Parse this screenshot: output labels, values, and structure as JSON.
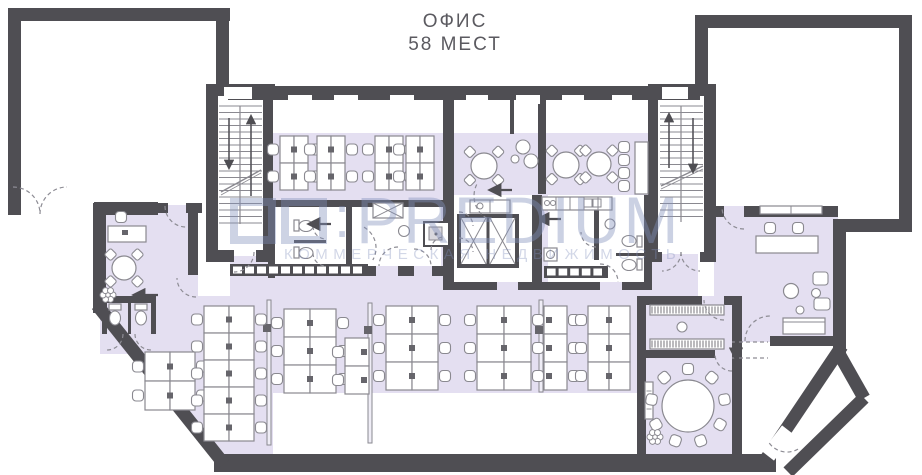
{
  "title": {
    "line1": "ОФИС",
    "line2": "58 МЕСТ"
  },
  "watermark": {
    "separator": ":",
    "brand": "PREDIUM",
    "tagline": "КОММЕРЧЕСКАЯ НЕДВИЖИМОСТЬ"
  },
  "colors": {
    "wall": "#4f4e53",
    "floor": "#e4dff1",
    "stroke": "#8a8990",
    "monitor": "#66656b",
    "dash": "#8d8c94",
    "white": "#ffffff",
    "partition": "#efedf6",
    "watermark": "rgba(131,145,188,0.42)",
    "title": "#5b5a60"
  },
  "plan": {
    "canvas": {
      "w": 922,
      "h": 475
    },
    "floor_zones": [
      {
        "t": "rect",
        "r": [
          228,
          133,
          470,
          169
        ]
      },
      {
        "t": "poly",
        "pts": [
          [
            97,
            296
          ],
          [
            230,
            296
          ],
          [
            230,
            302
          ],
          [
            637,
            302
          ],
          [
            637,
            458
          ],
          [
            225,
            458
          ],
          [
            97,
            308
          ]
        ]
      },
      {
        "t": "rect",
        "r": [
          637,
          296,
          103,
          162
        ]
      },
      {
        "t": "rect",
        "r": [
          95,
          205,
          103,
          100
        ]
      },
      {
        "t": "rect",
        "r": [
          100,
          296,
          58,
          58
        ]
      },
      {
        "t": "rect",
        "r": [
          714,
          206,
          124,
          136
        ]
      }
    ],
    "white_zones": [
      [
        275,
        207,
        166,
        59
      ],
      [
        454,
        195,
        78,
        87
      ],
      [
        548,
        195,
        96,
        87
      ],
      [
        273,
        393,
        364,
        63
      ],
      [
        218,
        96,
        45,
        160
      ],
      [
        658,
        96,
        46,
        158
      ],
      [
        198,
        213,
        32,
        83
      ]
    ],
    "walls": [
      [
        8,
        8,
        222,
        13
      ],
      [
        8,
        8,
        13,
        207
      ],
      [
        8,
        202,
        6,
        13
      ],
      [
        94,
        202,
        64,
        13
      ],
      [
        216,
        8,
        13,
        84
      ],
      [
        206,
        84,
        69,
        12
      ],
      [
        206,
        88,
        12,
        174
      ],
      [
        263,
        88,
        10,
        174
      ],
      [
        206,
        250,
        28,
        12
      ],
      [
        256,
        250,
        19,
        12
      ],
      [
        228,
        86,
        472,
        14
      ],
      [
        443,
        100,
        11,
        184
      ],
      [
        538,
        100,
        8,
        94
      ],
      [
        510,
        100,
        4,
        34
      ],
      [
        648,
        84,
        68,
        12
      ],
      [
        648,
        88,
        10,
        174
      ],
      [
        704,
        88,
        12,
        174
      ],
      [
        648,
        252,
        14,
        10
      ],
      [
        700,
        252,
        16,
        10
      ],
      [
        695,
        15,
        217,
        13
      ],
      [
        899,
        15,
        13,
        217
      ],
      [
        695,
        15,
        13,
        78
      ],
      [
        833,
        219,
        79,
        13
      ],
      [
        833,
        232,
        13,
        122
      ],
      [
        714,
        206,
        10,
        11
      ],
      [
        744,
        206,
        94,
        11
      ],
      [
        770,
        336,
        68,
        10
      ],
      [
        93,
        203,
        13,
        110
      ],
      [
        93,
        203,
        75,
        10
      ],
      [
        186,
        203,
        16,
        10
      ],
      [
        188,
        203,
        10,
        72
      ],
      [
        102,
        296,
        54,
        7
      ],
      [
        102,
        296,
        5,
        38
      ],
      [
        151,
        296,
        5,
        38
      ],
      [
        128,
        300,
        3,
        34
      ],
      [
        268,
        200,
        179,
        7
      ],
      [
        268,
        200,
        7,
        78
      ],
      [
        346,
        207,
        6,
        59
      ],
      [
        368,
        266,
        8,
        10
      ],
      [
        398,
        266,
        16,
        10
      ],
      [
        432,
        266,
        11,
        10
      ],
      [
        443,
        282,
        54,
        8
      ],
      [
        518,
        282,
        22,
        8
      ],
      [
        532,
        195,
        10,
        95
      ],
      [
        644,
        195,
        8,
        95
      ],
      [
        540,
        282,
        60,
        8
      ],
      [
        622,
        282,
        30,
        8
      ],
      [
        594,
        203,
        5,
        57
      ],
      [
        616,
        253,
        28,
        3
      ],
      [
        637,
        296,
        65,
        9
      ],
      [
        724,
        296,
        16,
        9
      ],
      [
        637,
        296,
        9,
        164
      ],
      [
        732,
        296,
        10,
        164
      ],
      [
        645,
        350,
        70,
        8
      ],
      [
        214,
        454,
        562,
        18
      ]
    ],
    "wall_lines": [
      [
        97,
        305,
        224,
        464,
        13
      ],
      [
        842,
        346,
        764,
        462,
        13
      ],
      [
        864,
        398,
        788,
        472,
        13
      ],
      [
        838,
        352,
        864,
        398,
        13
      ]
    ],
    "white_gaps": [
      [
        788,
        430,
        768,
        456,
        15
      ]
    ],
    "windows": [
      [
        224,
        87,
        28,
        12
      ],
      [
        662,
        87,
        26,
        12
      ],
      [
        288,
        95,
        24,
        9
      ],
      [
        334,
        95,
        24,
        9
      ],
      [
        390,
        95,
        24,
        9
      ],
      [
        466,
        95,
        22,
        9
      ],
      [
        516,
        95,
        24,
        9
      ],
      [
        562,
        95,
        22,
        9
      ],
      [
        612,
        95,
        20,
        9
      ]
    ],
    "lockers": [
      {
        "x": 230,
        "y": 264,
        "w": 138,
        "h": 12,
        "cells": 11
      },
      {
        "x": 544,
        "y": 266,
        "w": 64,
        "h": 12,
        "cells": 5
      }
    ],
    "stairs": [
      {
        "x": 219,
        "y": 106,
        "w": 43,
        "h": 118,
        "rail": 240,
        "slash": [
          221,
          192,
          261,
          170
        ],
        "arrows": [
          [
            229,
            118,
            229,
            168
          ],
          [
            251,
            196,
            251,
            116
          ]
        ]
      },
      {
        "x": 660,
        "y": 106,
        "w": 43,
        "h": 116,
        "rail": 681,
        "slash": [
          661,
          186,
          703,
          166
        ],
        "arrows": [
          [
            669,
            168,
            669,
            114
          ],
          [
            693,
            118,
            693,
            172
          ]
        ]
      }
    ],
    "elevator": {
      "box": [
        459,
        216,
        58,
        50
      ],
      "divX": 488
    },
    "elevator_counter": [
      470,
      200,
      40,
      13
    ],
    "kitchen_counter": {
      "r": [
        542,
        197,
        70,
        13
      ],
      "divs": [
        556,
        570,
        584,
        598
      ],
      "sink": [
        [
          584,
          199,
          8,
          8
        ],
        [
          593,
          199,
          8,
          8
        ]
      ],
      "burners": [
        [
          547,
          203
        ],
        [
          553,
          203
        ]
      ]
    },
    "bath_fixtures": {
      "toilets": [
        {
          "tank": [
            294,
            220,
            5,
            11
          ],
          "bowl": [
            306,
            226,
            7,
            5.5
          ]
        },
        {
          "tank": [
            294,
            247,
            5,
            11
          ],
          "bowl": [
            306,
            253,
            7,
            5.5
          ]
        },
        {
          "tank": [
            637,
            236,
            5,
            11
          ],
          "bowl": [
            629,
            241,
            7,
            5.5
          ]
        },
        {
          "tank": [
            637,
            259,
            5,
            11
          ],
          "bowl": [
            629,
            265,
            7,
            5.5
          ]
        }
      ],
      "wc_stalls": [
        {
          "tank": [
            109,
            304,
            12,
            6
          ],
          "bowl": [
            115,
            318,
            5.5,
            7
          ]
        },
        {
          "tank": [
            135,
            304,
            12,
            6
          ],
          "bowl": [
            141,
            318,
            5.5,
            7
          ]
        }
      ],
      "divider": [
        294,
        240,
        32,
        3
      ],
      "sinks": [
        [
          404,
          231,
          5.5
        ],
        [
          610,
          224,
          5
        ]
      ],
      "shower": {
        "outer": [
          424,
          222,
          25,
          24
        ],
        "inner": [
          429,
          227,
          13,
          13
        ],
        "dot": [
          436,
          234,
          1.5
        ]
      },
      "vent": [
        373,
        203,
        30,
        15
      ],
      "washer": {
        "r": [
          544,
          248,
          13,
          13
        ]
      }
    },
    "coat_racks": [
      [
        650,
        305,
        74,
        10
      ],
      [
        650,
        339,
        74,
        10
      ]
    ],
    "mirror": [
      682,
      327,
      5
    ],
    "radiator": [
      645,
      382,
      8,
      37
    ],
    "partitions": {
      "bars": [
        [
          267,
          300,
          4,
          145
        ],
        [
          368,
          303,
          4,
          140
        ],
        [
          539,
          300,
          4,
          92
        ]
      ],
      "dots": [
        [
          263,
          324,
          8,
          8
        ],
        [
          364,
          326,
          8,
          8
        ],
        [
          535,
          326,
          8,
          8
        ]
      ]
    },
    "desk_clusters": [
      {
        "x": 280,
        "y": 136,
        "cols": 2,
        "rows": 2,
        "cw": 14,
        "ch": 27,
        "sides": "lr"
      },
      {
        "x": 317,
        "y": 136,
        "cols": 2,
        "rows": 2,
        "cw": 14,
        "ch": 27,
        "sides": "lr"
      },
      {
        "x": 375,
        "y": 136,
        "cols": 2,
        "rows": 2,
        "cw": 14,
        "ch": 27,
        "sides": "lr"
      },
      {
        "x": 406,
        "y": 136,
        "cols": 2,
        "rows": 2,
        "cw": 14,
        "ch": 27,
        "sides": "l"
      },
      {
        "x": 145,
        "y": 352,
        "cols": 2,
        "rows": 2,
        "cw": 25,
        "ch": 29,
        "sides": "lr"
      },
      {
        "x": 204,
        "y": 306,
        "cols": 2,
        "rows": 5,
        "cw": 25,
        "ch": 27,
        "sides": "lr"
      },
      {
        "x": 284,
        "y": 309,
        "cols": 2,
        "rows": 3,
        "cw": 26,
        "ch": 28,
        "sides": "lr"
      },
      {
        "x": 345,
        "y": 338,
        "cols": 1,
        "rows": 2,
        "cw": 24,
        "ch": 28,
        "sides": "l"
      },
      {
        "x": 386,
        "y": 306,
        "cols": 2,
        "rows": 3,
        "cw": 26,
        "ch": 28,
        "sides": "lr"
      },
      {
        "x": 477,
        "y": 306,
        "cols": 2,
        "rows": 3,
        "cw": 27,
        "ch": 28,
        "sides": "lr"
      },
      {
        "x": 544,
        "y": 306,
        "cols": 1,
        "rows": 3,
        "cw": 23,
        "ch": 28,
        "sides": "r"
      },
      {
        "x": 588,
        "y": 306,
        "cols": 2,
        "rows": 3,
        "cw": 21,
        "ch": 28,
        "sides": "l"
      }
    ],
    "round_tables": [
      {
        "cx": 484,
        "cy": 166,
        "r": 13
      },
      {
        "cx": 566,
        "cy": 165,
        "r": 13
      },
      {
        "cx": 599,
        "cy": 164,
        "r": 12
      },
      {
        "cx": 124,
        "cy": 268,
        "r": 12
      }
    ],
    "meeting_table": {
      "cx": 688,
      "cy": 406,
      "r": 26,
      "chairs": 9,
      "chairR": 37
    },
    "lounge": {
      "armchairs": [
        [
          813,
          272,
          15,
          13
        ],
        [
          814,
          298,
          16,
          12
        ]
      ],
      "table": [
        791,
        291,
        7.5
      ],
      "poufs": [
        [
          816,
          293,
          4.5
        ],
        [
          800,
          310,
          4
        ]
      ],
      "sofa": [
        783,
        318,
        42,
        16
      ]
    },
    "reception": {
      "desk": [
        756,
        236,
        62,
        17
      ],
      "chairs": [
        [
          770,
          228
        ],
        [
          798,
          228
        ]
      ],
      "shelf": [
        760,
        206,
        62,
        8
      ]
    },
    "bar": {
      "counter": [
        635,
        142,
        13,
        52
      ],
      "stools": [
        [
          624,
          147
        ],
        [
          624,
          160
        ],
        [
          624,
          173
        ],
        [
          624,
          186
        ]
      ]
    },
    "office_desk": {
      "desk": [
        108,
        226,
        38,
        16
      ],
      "chair": [
        121,
        217
      ],
      "monitor": [
        122,
        230,
        6,
        5
      ]
    },
    "poufs": [
      [
        523,
        147,
        7
      ],
      [
        515,
        159,
        4
      ],
      [
        531,
        161,
        7
      ]
    ],
    "plants": [
      [
        108,
        295
      ],
      [
        655,
        437
      ]
    ],
    "door_arcs": [
      {
        "c": [
          13,
          214
        ],
        "r": 27,
        "a0": -90,
        "a1": 0,
        "sw": 1
      },
      {
        "c": [
          67,
          214
        ],
        "r": 27,
        "a0": 180,
        "a1": 270,
        "sw": 1
      },
      {
        "c": [
          186,
          206
        ],
        "r": 21,
        "a0": 180,
        "a1": 90,
        "sw": 0
      },
      {
        "c": [
          196,
          278
        ],
        "r": 19,
        "a0": 90,
        "a1": 180,
        "sw": 1
      },
      {
        "c": [
          107,
          334
        ],
        "r": 16,
        "a0": 0,
        "a1": 90,
        "sw": 1
      },
      {
        "c": [
          151,
          334
        ],
        "r": 16,
        "a0": 180,
        "a1": 90,
        "sw": 0
      },
      {
        "c": [
          234,
          252
        ],
        "r": 20,
        "a0": 0,
        "a1": 90,
        "sw": 1
      },
      {
        "c": [
          326,
          226
        ],
        "r": 13,
        "a0": 180,
        "a1": 90,
        "sw": 0
      },
      {
        "c": [
          326,
          253
        ],
        "r": 13,
        "a0": 180,
        "a1": 90,
        "sw": 0
      },
      {
        "c": [
          398,
          266
        ],
        "r": 19,
        "a0": 270,
        "a1": 180,
        "sw": 0
      },
      {
        "c": [
          414,
          266
        ],
        "r": 17,
        "a0": 270,
        "a1": 360,
        "sw": 1
      },
      {
        "c": [
          444,
          250
        ],
        "r": 13,
        "a0": 180,
        "a1": 270,
        "sw": 1
      },
      {
        "c": [
          459,
          226
        ],
        "r": 14,
        "a0": 270,
        "a1": 360,
        "sw": 1
      },
      {
        "c": [
          459,
          252
        ],
        "r": 14,
        "a0": 270,
        "a1": 360,
        "sw": 1
      },
      {
        "c": [
          596,
          232
        ],
        "r": 15,
        "a0": 90,
        "a1": 180,
        "sw": 1
      },
      {
        "c": [
          600,
          282
        ],
        "r": 18,
        "a0": 270,
        "a1": 360,
        "sw": 1
      },
      {
        "c": [
          662,
          252
        ],
        "r": 19,
        "a0": 0,
        "a1": 90,
        "sw": 1
      },
      {
        "c": [
          700,
          252
        ],
        "r": 19,
        "a0": 180,
        "a1": 90,
        "sw": 0
      },
      {
        "c": [
          744,
          207
        ],
        "r": 22,
        "a0": 90,
        "a1": 180,
        "sw": 1
      },
      {
        "c": [
          770,
          341
        ],
        "r": 25,
        "a0": 180,
        "a1": 270,
        "sw": 1
      },
      {
        "c": [
          724,
          300
        ],
        "r": 20,
        "a0": 90,
        "a1": 180,
        "sw": 1
      },
      {
        "c": [
          732,
          354
        ],
        "r": 17,
        "a0": 90,
        "a1": 180,
        "sw": 1
      },
      {
        "c": [
          787,
          430
        ],
        "r": 22,
        "a0": 60,
        "a1": 150,
        "sw": 1
      },
      {
        "c": [
          500,
          196
        ],
        "r": 26,
        "a0": 120,
        "a1": 210,
        "sw": 1
      },
      {
        "c": [
          352,
          248
        ],
        "r": 24,
        "a0": 300,
        "a1": 30,
        "sw": 1
      }
    ],
    "dash_lines": [
      [
        732,
        342,
        768,
        342
      ],
      [
        732,
        358,
        768,
        358
      ]
    ],
    "arrows": [
      [
        158,
        295,
        134,
        295
      ],
      [
        331,
        224,
        309,
        224
      ],
      [
        512,
        190,
        490,
        190
      ],
      [
        561,
        219,
        538,
        219
      ],
      [
        736,
        340,
        736,
        359
      ]
    ]
  }
}
